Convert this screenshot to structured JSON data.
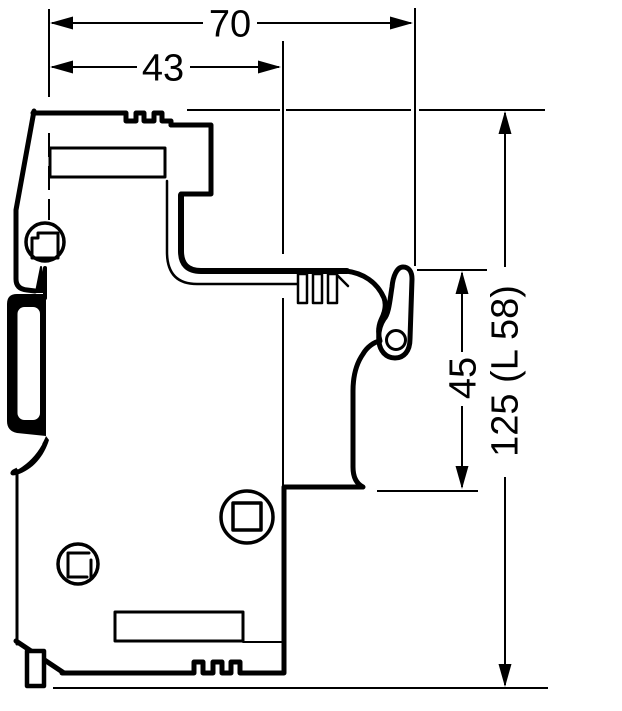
{
  "diagram": {
    "type": "technical-dimension-drawing",
    "subject": "side view of DIN-rail mounted modular device with mounting dimensions",
    "colors": {
      "line": "#000000",
      "background": "#ffffff"
    },
    "dimensions": {
      "total_width": {
        "label": "70"
      },
      "body_width": {
        "label": "43"
      },
      "upper_height": {
        "label": "45"
      },
      "total_height": {
        "label": "125 (L 58)"
      }
    }
  }
}
